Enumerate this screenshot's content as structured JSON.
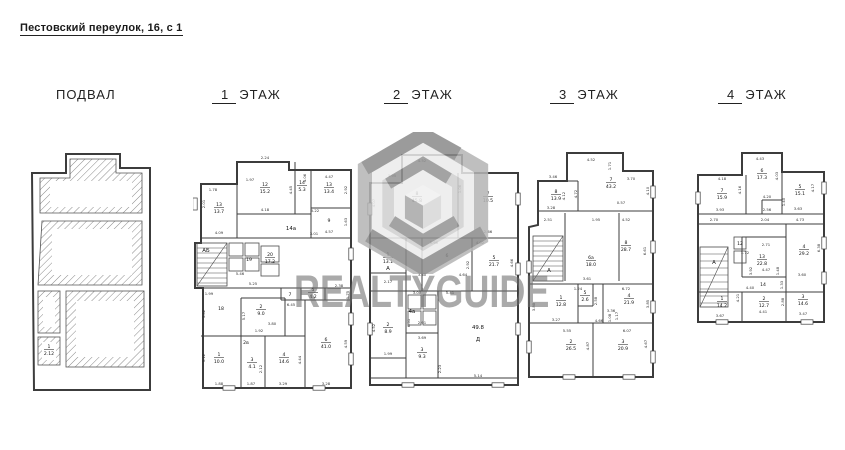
{
  "page": {
    "title": "Пестовский переулок, 16, с 1"
  },
  "watermark": {
    "brand": "REALTYGUIDE",
    "logo": "realtyguide-cube-logo",
    "text_color": "#9b9b9b",
    "logo_grays": [
      "#8a8a8a",
      "#b5b5b5",
      "#d8d8d8",
      "#ececec"
    ]
  },
  "floors": [
    {
      "id": "podval",
      "header": {
        "num": "",
        "word": "ПОДВАЛ"
      },
      "rooms": [
        {
          "n": "1",
          "a": "2.12",
          "x": 21,
          "y": 203
        }
      ],
      "texts": [],
      "letters": []
    },
    {
      "id": "f1",
      "header": {
        "num": "1",
        "word": "ЭТАЖ"
      },
      "rooms": [
        {
          "n": "13",
          "a": "13.7",
          "x": 26,
          "y": 58
        },
        {
          "n": "12",
          "a": "15.2",
          "x": 72,
          "y": 38
        },
        {
          "n": "14",
          "a": "5.3",
          "x": 109,
          "y": 36
        },
        {
          "n": "13",
          "a": "13.4",
          "x": 136,
          "y": 38
        },
        {
          "n": "9",
          "a": "",
          "x": 136,
          "y": 74
        },
        {
          "n": "19",
          "a": "",
          "x": 56,
          "y": 113
        },
        {
          "n": "20",
          "a": "17.2",
          "x": 77,
          "y": 108
        },
        {
          "n": "18",
          "a": "",
          "x": 28,
          "y": 162
        },
        {
          "n": "2",
          "a": "9.0",
          "x": 68,
          "y": 160
        },
        {
          "n": "7",
          "a": "",
          "x": 97,
          "y": 148
        },
        {
          "n": "5",
          "a": "4.2",
          "x": 120,
          "y": 143
        },
        {
          "n": "1",
          "a": "10.0",
          "x": 26,
          "y": 208
        },
        {
          "n": "2в",
          "a": "",
          "x": 53,
          "y": 196
        },
        {
          "n": "3",
          "a": "4.1",
          "x": 59,
          "y": 213
        },
        {
          "n": "4",
          "a": "14.6",
          "x": 91,
          "y": 208
        },
        {
          "n": "6",
          "a": "41.0",
          "x": 133,
          "y": 193
        }
      ],
      "texts": [
        {
          "t": "2.24",
          "x": 72,
          "y": 11
        },
        {
          "t": "1.78",
          "x": 20,
          "y": 43
        },
        {
          "t": "1.97",
          "x": 57,
          "y": 33
        },
        {
          "t": "2.01",
          "x": 12,
          "y": 56,
          "r": -90
        },
        {
          "t": "4.45",
          "x": 99,
          "y": 42,
          "r": -90
        },
        {
          "t": "4.06",
          "x": 113,
          "y": 30,
          "r": -90
        },
        {
          "t": "4.18",
          "x": 72,
          "y": 63
        },
        {
          "t": "4.09",
          "x": 26,
          "y": 86
        },
        {
          "t": "4.47",
          "x": 136,
          "y": 30
        },
        {
          "t": "2.92",
          "x": 154,
          "y": 42,
          "r": -90
        },
        {
          "t": "4.57",
          "x": 136,
          "y": 85
        },
        {
          "t": "1.63",
          "x": 154,
          "y": 74,
          "r": -90
        },
        {
          "t": "3.01",
          "x": 121,
          "y": 87
        },
        {
          "t": "5.22",
          "x": 122,
          "y": 64
        },
        {
          "t": "5.46",
          "x": 47,
          "y": 127
        },
        {
          "t": "5.25",
          "x": 60,
          "y": 137
        },
        {
          "t": "1.99",
          "x": 16,
          "y": 147
        },
        {
          "t": "3.62",
          "x": 12,
          "y": 166,
          "r": -90
        },
        {
          "t": "5.17",
          "x": 52,
          "y": 168,
          "r": -90
        },
        {
          "t": "1.92",
          "x": 66,
          "y": 184
        },
        {
          "t": "6.45",
          "x": 98,
          "y": 158
        },
        {
          "t": "2.38",
          "x": 146,
          "y": 139
        },
        {
          "t": "1.75",
          "x": 156,
          "y": 147,
          "r": -90
        },
        {
          "t": "3.80",
          "x": 79,
          "y": 177
        },
        {
          "t": "5.12",
          "x": 12,
          "y": 210,
          "r": -90
        },
        {
          "t": "1.88",
          "x": 26,
          "y": 237
        },
        {
          "t": "2.12",
          "x": 69,
          "y": 221,
          "r": -90
        },
        {
          "t": "1.87",
          "x": 58,
          "y": 237
        },
        {
          "t": "4.44",
          "x": 108,
          "y": 212,
          "r": -90
        },
        {
          "t": "3.29",
          "x": 90,
          "y": 237
        },
        {
          "t": "3.28",
          "x": 133,
          "y": 237
        },
        {
          "t": "4.59",
          "x": 154,
          "y": 196,
          "r": -90
        }
      ],
      "letters": [
        {
          "t": "14а",
          "x": 98,
          "y": 82
        },
        {
          "t": "АБ",
          "x": 13,
          "y": 104
        }
      ]
    },
    {
      "id": "f2",
      "header": {
        "num": "2",
        "word": "ЭТАЖ"
      },
      "rooms": [
        {
          "n": "8",
          "a": "45.8",
          "x": 55,
          "y": 52
        },
        {
          "n": "7",
          "a": "10.5",
          "x": 126,
          "y": 52
        },
        {
          "n": "6",
          "a": "",
          "x": 85,
          "y": 114
        },
        {
          "n": "5",
          "a": "21.7",
          "x": 132,
          "y": 116
        },
        {
          "n": "1",
          "a": "13.1",
          "x": 26,
          "y": 113
        },
        {
          "n": "2",
          "a": "8.9",
          "x": 26,
          "y": 183
        },
        {
          "n": "3",
          "a": "9.3",
          "x": 60,
          "y": 208
        }
      ],
      "texts": [
        {
          "t": "4.52",
          "x": 60,
          "y": 19
        },
        {
          "t": "3.95",
          "x": 30,
          "y": 34
        },
        {
          "t": "4.07",
          "x": 13,
          "y": 60,
          "r": -90
        },
        {
          "t": "1.06",
          "x": 99,
          "y": 46,
          "r": -90
        },
        {
          "t": "2.66",
          "x": 126,
          "y": 90
        },
        {
          "t": "1.98",
          "x": 72,
          "y": 101
        },
        {
          "t": "4.02",
          "x": 118,
          "y": 101
        },
        {
          "t": "2.92",
          "x": 107,
          "y": 122,
          "r": -90
        },
        {
          "t": "4.66",
          "x": 151,
          "y": 120,
          "r": -90
        },
        {
          "t": "2.17",
          "x": 26,
          "y": 140
        },
        {
          "t": "3.60",
          "x": 60,
          "y": 133
        },
        {
          "t": "4.64",
          "x": 101,
          "y": 133
        },
        {
          "t": "3.00",
          "x": 55,
          "y": 151
        },
        {
          "t": "5.41",
          "x": 88,
          "y": 151
        },
        {
          "t": "4.52",
          "x": 13,
          "y": 185,
          "r": -90
        },
        {
          "t": "1.99",
          "x": 26,
          "y": 212
        },
        {
          "t": "2.91",
          "x": 60,
          "y": 181
        },
        {
          "t": "3.69",
          "x": 60,
          "y": 196
        },
        {
          "t": "6.51",
          "x": 48,
          "y": 180,
          "r": -90
        },
        {
          "t": "2.23",
          "x": 79,
          "y": 226,
          "r": -90
        },
        {
          "t": "5.14",
          "x": 116,
          "y": 234
        }
      ],
      "letters": [
        {
          "t": "49.8",
          "x": 116,
          "y": 186
        },
        {
          "t": "Д",
          "x": 116,
          "y": 198
        },
        {
          "t": "А",
          "x": 26,
          "y": 127
        },
        {
          "t": "4а",
          "x": 50,
          "y": 170
        }
      ]
    },
    {
      "id": "f3",
      "header": {
        "num": "3",
        "word": "ЭТАЖ"
      },
      "rooms": [
        {
          "n": "8",
          "a": "13.9",
          "x": 33,
          "y": 52
        },
        {
          "n": "7",
          "a": "43.2",
          "x": 88,
          "y": 40
        },
        {
          "n": "8",
          "a": "28.7",
          "x": 103,
          "y": 103
        },
        {
          "n": "6а",
          "a": "18.0",
          "x": 68,
          "y": 118
        },
        {
          "n": "1",
          "a": "12.8",
          "x": 38,
          "y": 158
        },
        {
          "n": "5",
          "a": "2.6",
          "x": 62,
          "y": 153
        },
        {
          "n": "4",
          "a": "21.9",
          "x": 106,
          "y": 156
        },
        {
          "n": "2",
          "a": "26.5",
          "x": 48,
          "y": 202
        },
        {
          "n": "3",
          "a": "20.9",
          "x": 100,
          "y": 202
        }
      ],
      "texts": [
        {
          "t": "3.46",
          "x": 30,
          "y": 37
        },
        {
          "t": "4.52",
          "x": 68,
          "y": 20
        },
        {
          "t": "1.71",
          "x": 88,
          "y": 25,
          "r": -90
        },
        {
          "t": "3.70",
          "x": 108,
          "y": 39
        },
        {
          "t": "4.10",
          "x": 126,
          "y": 50,
          "r": -90
        },
        {
          "t": "0.57",
          "x": 98,
          "y": 63
        },
        {
          "t": "4.12",
          "x": 42,
          "y": 55,
          "r": -90
        },
        {
          "t": "4.72",
          "x": 54,
          "y": 53,
          "r": -90
        },
        {
          "t": "3.28",
          "x": 28,
          "y": 68
        },
        {
          "t": "2.51",
          "x": 25,
          "y": 80
        },
        {
          "t": "1.95",
          "x": 73,
          "y": 80
        },
        {
          "t": "4.52",
          "x": 103,
          "y": 80
        },
        {
          "t": "6.61",
          "x": 123,
          "y": 110,
          "r": -90
        },
        {
          "t": "3.61",
          "x": 64,
          "y": 139
        },
        {
          "t": "1.24",
          "x": 55,
          "y": 149
        },
        {
          "t": "2.58",
          "x": 74,
          "y": 160,
          "r": -90
        },
        {
          "t": "3.36",
          "x": 88,
          "y": 171
        },
        {
          "t": "6.72",
          "x": 103,
          "y": 149
        },
        {
          "t": "3.85",
          "x": 126,
          "y": 163,
          "r": -90
        },
        {
          "t": "3.80",
          "x": 12,
          "y": 166,
          "r": -90
        },
        {
          "t": "3.27",
          "x": 33,
          "y": 180
        },
        {
          "t": "4.66",
          "x": 76,
          "y": 181
        },
        {
          "t": "1.08",
          "x": 88,
          "y": 177,
          "r": -90
        },
        {
          "t": "1.17",
          "x": 95,
          "y": 175,
          "r": -90
        },
        {
          "t": "5.55",
          "x": 44,
          "y": 191
        },
        {
          "t": "6.07",
          "x": 104,
          "y": 191
        },
        {
          "t": "4.87",
          "x": 66,
          "y": 205,
          "r": -90
        },
        {
          "t": "4.67",
          "x": 124,
          "y": 203,
          "r": -90
        }
      ],
      "letters": [
        {
          "t": "А",
          "x": 26,
          "y": 131
        }
      ]
    },
    {
      "id": "f4",
      "header": {
        "num": "4",
        "word": "ЭТАЖ"
      },
      "rooms": [
        {
          "n": "7",
          "a": "15.9",
          "x": 36,
          "y": 50
        },
        {
          "n": "6",
          "a": "17.3",
          "x": 76,
          "y": 30
        },
        {
          "n": "5",
          "a": "15.1",
          "x": 114,
          "y": 46
        },
        {
          "n": "12",
          "a": "",
          "x": 54,
          "y": 103
        },
        {
          "n": "13",
          "a": "22.8",
          "x": 76,
          "y": 116
        },
        {
          "n": "14",
          "a": "",
          "x": 77,
          "y": 144
        },
        {
          "n": "4",
          "a": "29.2",
          "x": 118,
          "y": 106
        },
        {
          "n": "1",
          "a": "14.2",
          "x": 36,
          "y": 158
        },
        {
          "n": "2",
          "a": "12.7",
          "x": 78,
          "y": 158
        },
        {
          "n": "3",
          "a": "14.6",
          "x": 117,
          "y": 156
        }
      ],
      "texts": [
        {
          "t": "4.18",
          "x": 36,
          "y": 38
        },
        {
          "t": "4.43",
          "x": 74,
          "y": 18
        },
        {
          "t": "4.03",
          "x": 92,
          "y": 34,
          "r": -90
        },
        {
          "t": "4.16",
          "x": 55,
          "y": 48,
          "r": -90
        },
        {
          "t": "3.93",
          "x": 34,
          "y": 69
        },
        {
          "t": "4.20",
          "x": 81,
          "y": 56
        },
        {
          "t": "2.56",
          "x": 81,
          "y": 69
        },
        {
          "t": "4.17",
          "x": 128,
          "y": 46,
          "r": -90
        },
        {
          "t": "3.63",
          "x": 112,
          "y": 68
        },
        {
          "t": "1.40",
          "x": 99,
          "y": 60,
          "r": -90
        },
        {
          "t": "2.70",
          "x": 28,
          "y": 79
        },
        {
          "t": "2.04",
          "x": 79,
          "y": 79
        },
        {
          "t": "4.73",
          "x": 114,
          "y": 79
        },
        {
          "t": "2.71",
          "x": 80,
          "y": 104
        },
        {
          "t": "1.72",
          "x": 59,
          "y": 112
        },
        {
          "t": "3.92",
          "x": 66,
          "y": 129,
          "r": -90
        },
        {
          "t": "4.47",
          "x": 80,
          "y": 129
        },
        {
          "t": "1.48",
          "x": 93,
          "y": 129,
          "r": -90
        },
        {
          "t": "3.60",
          "x": 116,
          "y": 134
        },
        {
          "t": "4.40",
          "x": 64,
          "y": 147
        },
        {
          "t": "1.33",
          "x": 97,
          "y": 143,
          "r": -90
        },
        {
          "t": "4.21",
          "x": 53,
          "y": 156,
          "r": -90
        },
        {
          "t": "2.88",
          "x": 98,
          "y": 160,
          "r": -90
        },
        {
          "t": "4.41",
          "x": 77,
          "y": 171
        },
        {
          "t": "3.67",
          "x": 34,
          "y": 175
        },
        {
          "t": "3.47",
          "x": 117,
          "y": 173
        },
        {
          "t": "6.38",
          "x": 134,
          "y": 106,
          "r": -90
        }
      ],
      "letters": [
        {
          "t": "А",
          "x": 28,
          "y": 122
        }
      ]
    }
  ]
}
